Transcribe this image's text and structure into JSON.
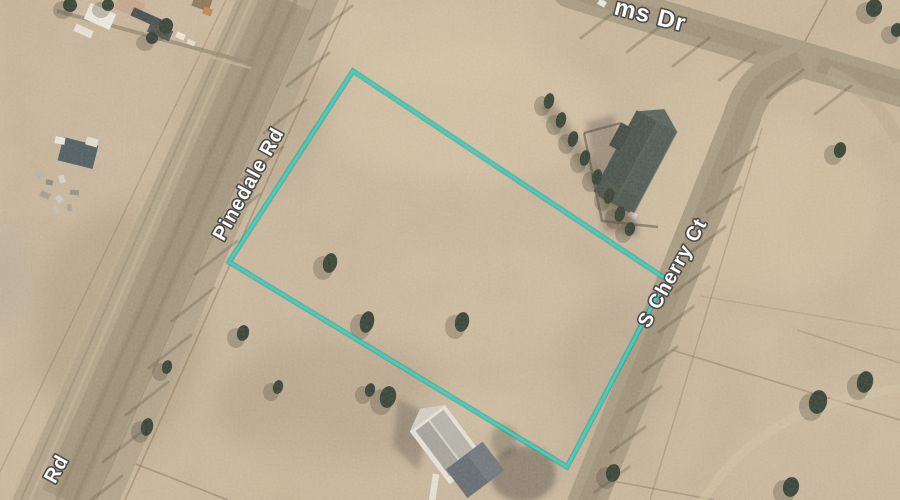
{
  "map_labels": {
    "pinedale_rd": "Pinedale Rd",
    "s_cherry_ct": "S Cherry Ct",
    "ms_dr": "ms Dr",
    "rd_partial": "Rd"
  },
  "palette": {
    "terrain": "#c6b296",
    "road": "#a89a81",
    "parcel_line": "#3bd2c2",
    "parcel_line_glow": "#1f9488",
    "label_fill": "#ffffff",
    "label_stroke": "#4e4d49",
    "tree": "#2e3b2e",
    "tree_shadow": "#473f30"
  },
  "parcel": {
    "corners": [
      [
        353,
        71
      ],
      [
        666,
        279
      ],
      [
        567,
        467
      ],
      [
        229,
        262
      ]
    ]
  },
  "trees": [
    {
      "x": 330,
      "y": 263,
      "rx": 7,
      "ry": 10
    },
    {
      "x": 367,
      "y": 322,
      "rx": 7,
      "ry": 11
    },
    {
      "x": 462,
      "y": 322,
      "rx": 7,
      "ry": 10
    },
    {
      "x": 243,
      "y": 333,
      "rx": 6,
      "ry": 8
    },
    {
      "x": 278,
      "y": 387,
      "rx": 5,
      "ry": 7
    },
    {
      "x": 388,
      "y": 397,
      "rx": 8,
      "ry": 11
    },
    {
      "x": 370,
      "y": 390,
      "rx": 5,
      "ry": 7
    },
    {
      "x": 147,
      "y": 427,
      "rx": 6,
      "ry": 9
    },
    {
      "x": 167,
      "y": 367,
      "rx": 5,
      "ry": 7
    },
    {
      "x": 613,
      "y": 473,
      "rx": 7,
      "ry": 9
    },
    {
      "x": 818,
      "y": 402,
      "rx": 9,
      "ry": 12
    },
    {
      "x": 865,
      "y": 382,
      "rx": 8,
      "ry": 11
    },
    {
      "x": 791,
      "y": 487,
      "rx": 8,
      "ry": 10
    },
    {
      "x": 840,
      "y": 150,
      "rx": 6,
      "ry": 8
    },
    {
      "x": 874,
      "y": 8,
      "rx": 8,
      "ry": 9
    },
    {
      "x": 897,
      "y": 30,
      "rx": 6,
      "ry": 7
    },
    {
      "x": 549,
      "y": 101,
      "rx": 5,
      "ry": 8
    },
    {
      "x": 561,
      "y": 120,
      "rx": 5,
      "ry": 8
    },
    {
      "x": 573,
      "y": 139,
      "rx": 5,
      "ry": 8
    },
    {
      "x": 585,
      "y": 158,
      "rx": 5,
      "ry": 8
    },
    {
      "x": 597,
      "y": 177,
      "rx": 5,
      "ry": 8
    },
    {
      "x": 609,
      "y": 196,
      "rx": 5,
      "ry": 8
    },
    {
      "x": 620,
      "y": 214,
      "rx": 5,
      "ry": 8
    },
    {
      "x": 630,
      "y": 229,
      "rx": 5,
      "ry": 7
    },
    {
      "x": 70,
      "y": 5,
      "rx": 7,
      "ry": 7
    },
    {
      "x": 108,
      "y": 5,
      "rx": 6,
      "ry": 6
    },
    {
      "x": 166,
      "y": 26,
      "rx": 7,
      "ry": 8
    },
    {
      "x": 152,
      "y": 38,
      "rx": 6,
      "ry": 6
    }
  ],
  "blobs": [
    {
      "x": 86,
      "y": 8,
      "w": 28,
      "h": 17,
      "r": 24,
      "fill": "#efece3"
    },
    {
      "x": 116,
      "y": -2,
      "w": 27,
      "h": 16,
      "r": 24,
      "fill": "#c8a48b"
    },
    {
      "x": 131,
      "y": 13,
      "w": 30,
      "h": 9,
      "r": 24,
      "fill": "#3e464c"
    },
    {
      "x": 148,
      "y": 26,
      "w": 24,
      "h": 11,
      "r": 24,
      "fill": "#49525a"
    },
    {
      "x": 74,
      "y": 27,
      "w": 19,
      "h": 8,
      "r": 24,
      "fill": "#e7e4da"
    },
    {
      "x": 193,
      "y": -4,
      "w": 18,
      "h": 13,
      "r": 20,
      "fill": "#8d7357"
    },
    {
      "x": 203,
      "y": 8,
      "w": 9,
      "h": 7,
      "r": 20,
      "fill": "#c08448"
    },
    {
      "x": 176,
      "y": 33,
      "w": 9,
      "h": 6,
      "r": 24,
      "fill": "#efeade"
    },
    {
      "x": 187,
      "y": 40,
      "w": 8,
      "h": 5,
      "r": 24,
      "fill": "#e6e0d2"
    },
    {
      "x": 60,
      "y": 141,
      "w": 36,
      "h": 24,
      "r": 14,
      "fill": "#4a585c"
    },
    {
      "x": 55,
      "y": 137,
      "w": 10,
      "h": 7,
      "r": 10,
      "fill": "#eceadf"
    },
    {
      "x": 86,
      "y": 138,
      "w": 12,
      "h": 8,
      "r": 16,
      "fill": "#e4e2d6"
    },
    {
      "x": 34,
      "y": 172,
      "w": 9,
      "h": 6,
      "r": 40,
      "fill": "#b9b4a8"
    },
    {
      "x": 46,
      "y": 180,
      "w": 7,
      "h": 5,
      "r": 10,
      "fill": "#8f897c"
    },
    {
      "x": 58,
      "y": 176,
      "w": 8,
      "h": 6,
      "r": 70,
      "fill": "#d8d4c8"
    },
    {
      "x": 40,
      "y": 192,
      "w": 10,
      "h": 6,
      "r": 25,
      "fill": "#a49e90"
    },
    {
      "x": 56,
      "y": 196,
      "w": 7,
      "h": 6,
      "r": 55,
      "fill": "#cfccc0"
    },
    {
      "x": 70,
      "y": 190,
      "w": 9,
      "h": 5,
      "r": 5,
      "fill": "#968f81"
    },
    {
      "x": 52,
      "y": 207,
      "w": 8,
      "h": 5,
      "r": 35,
      "fill": "#c4c0b4"
    },
    {
      "x": 66,
      "y": 205,
      "w": 7,
      "h": 5,
      "r": 80,
      "fill": "#aaa496"
    },
    {
      "x": 616,
      "y": 192,
      "w": 10,
      "h": 6,
      "r": 28,
      "fill": "#eceae1"
    },
    {
      "x": 628,
      "y": 212,
      "w": 9,
      "h": 6,
      "r": 28,
      "fill": "#e4e1d6"
    },
    {
      "x": 598,
      "y": 0,
      "w": 8,
      "h": 6,
      "r": 30,
      "fill": "#f5f5f2",
      "op": 0.9
    }
  ],
  "pole_shadows": [
    {
      "name": "pinedale-poles",
      "vec": [
        -42,
        33
      ],
      "points": [
        [
          352,
          6
        ],
        [
          329,
          53
        ],
        [
          306,
          100
        ],
        [
          283,
          147
        ],
        [
          260,
          194
        ],
        [
          237,
          241
        ],
        [
          214,
          288
        ],
        [
          191,
          335
        ],
        [
          168,
          382
        ],
        [
          145,
          429
        ],
        [
          122,
          476
        ]
      ]
    },
    {
      "name": "dr-poles",
      "vec": [
        -36,
        28
      ],
      "points": [
        [
          617,
          10
        ],
        [
          663,
          24
        ],
        [
          709,
          38
        ],
        [
          755,
          52
        ],
        [
          803,
          70
        ],
        [
          851,
          86
        ]
      ]
    },
    {
      "name": "cherry-poles",
      "vec": [
        -34,
        25
      ],
      "points": [
        [
          757,
          147
        ],
        [
          741,
          187
        ],
        [
          725,
          227
        ],
        [
          709,
          267
        ],
        [
          693,
          307
        ],
        [
          677,
          347
        ],
        [
          661,
          387
        ],
        [
          645,
          427
        ],
        [
          629,
          467
        ]
      ]
    }
  ]
}
